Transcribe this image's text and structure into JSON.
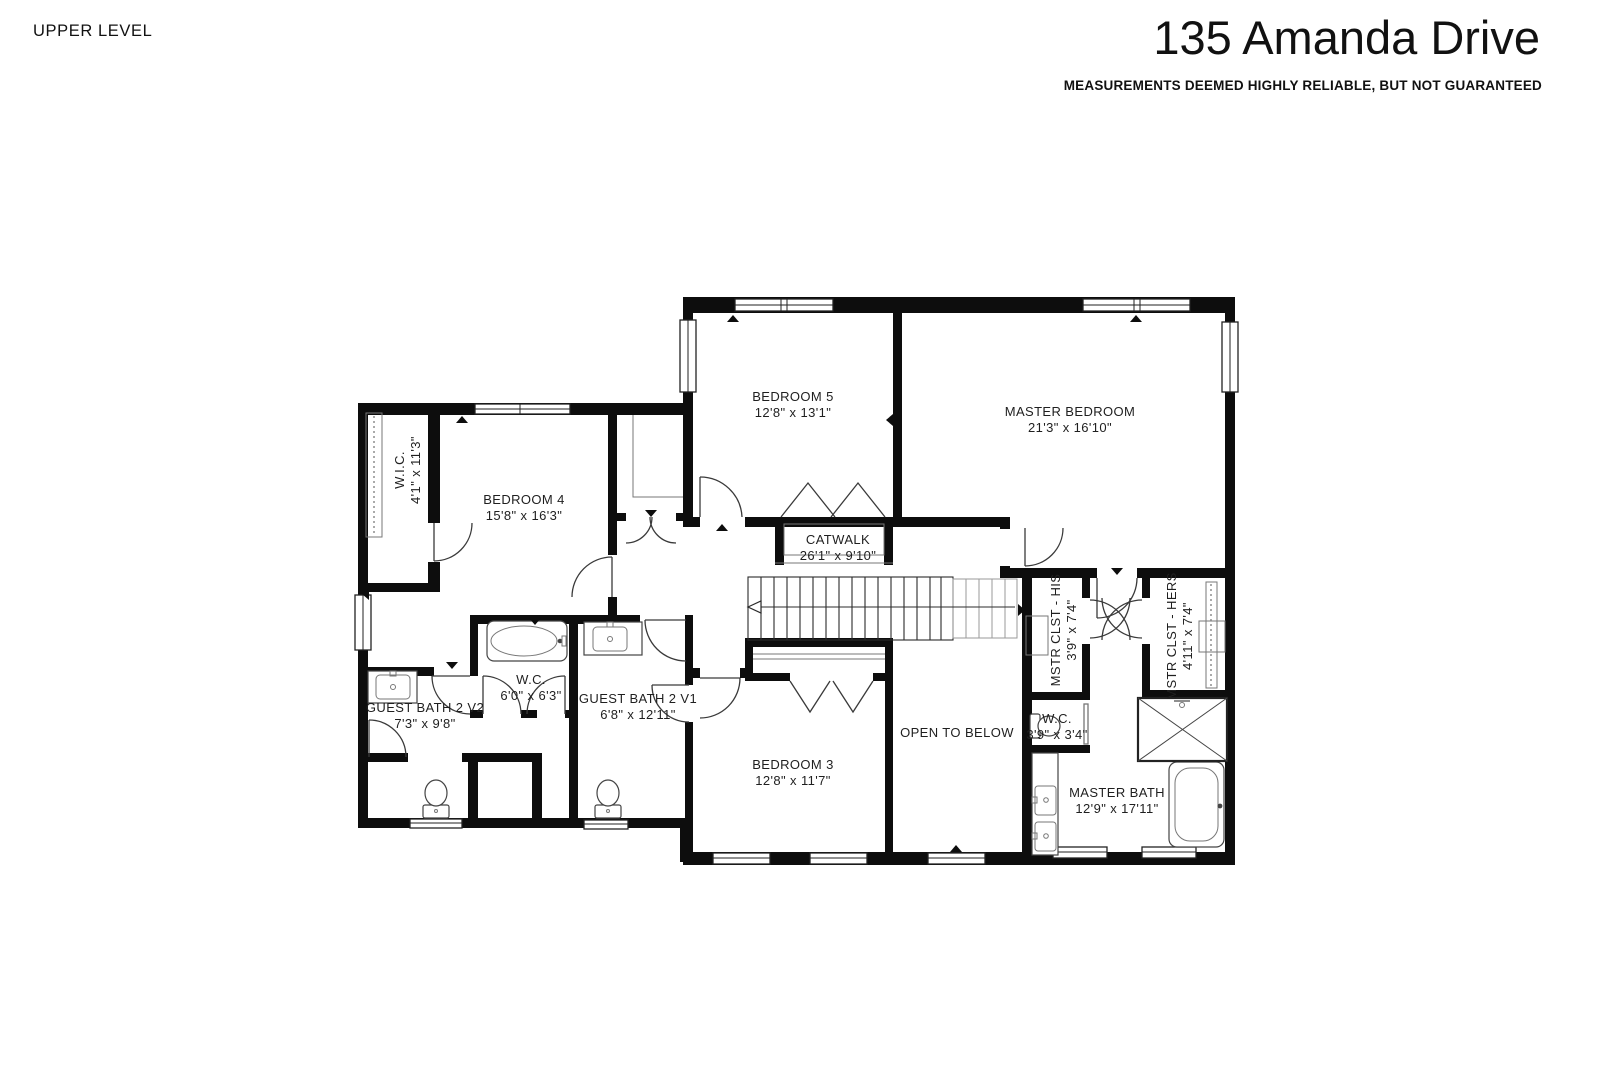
{
  "header": {
    "level_label": "UPPER LEVEL",
    "title": "135 Amanda Drive",
    "disclaimer": "MEASUREMENTS DEEMED HIGHLY RELIABLE, BUT NOT GUARANTEED"
  },
  "plan": {
    "wall_color": "#0d0d0d",
    "label_color": "#1f1f1f",
    "rooms": [
      {
        "id": "bedroom-5",
        "name": "BEDROOM 5",
        "dims": "12'8\" x 13'1\"",
        "x": 793,
        "y": 397,
        "rot": 0
      },
      {
        "id": "master-bedroom",
        "name": "MASTER BEDROOM",
        "dims": "21'3\" x 16'10\"",
        "x": 1070,
        "y": 412,
        "rot": 0
      },
      {
        "id": "wic",
        "name": "W.I.C.",
        "dims": "4'1\" x 11'3\"",
        "x": 408,
        "y": 470,
        "rot": -90
      },
      {
        "id": "bedroom-4",
        "name": "BEDROOM 4",
        "dims": "15'8\" x 16'3\"",
        "x": 524,
        "y": 500,
        "rot": 0
      },
      {
        "id": "catwalk",
        "name": "CATWALK",
        "dims": "26'1\" x 9'10\"",
        "x": 838,
        "y": 540,
        "rot": 0
      },
      {
        "id": "guest-bath-2-v2",
        "name": "GUEST BATH 2 V2",
        "dims": "7'3\" x 9'8\"",
        "x": 425,
        "y": 708,
        "rot": 0
      },
      {
        "id": "wc-guest",
        "name": "W.C.",
        "dims": "6'0\" x 6'3\"",
        "x": 531,
        "y": 680,
        "rot": 0
      },
      {
        "id": "guest-bath-2-v1",
        "name": "GUEST BATH 2 V1",
        "dims": "6'8\" x 12'11\"",
        "x": 638,
        "y": 699,
        "rot": 0
      },
      {
        "id": "bedroom-3",
        "name": "BEDROOM 3",
        "dims": "12'8\" x 11'7\"",
        "x": 793,
        "y": 765,
        "rot": 0
      },
      {
        "id": "open-to-below",
        "name": "OPEN TO BELOW",
        "dims": "",
        "x": 957,
        "y": 733,
        "rot": 0
      },
      {
        "id": "mstr-clst-his",
        "name": "MSTR CLST - HIS",
        "dims": "3'9\" x 7'4\"",
        "x": 1064,
        "y": 630,
        "rot": -90
      },
      {
        "id": "mstr-clst-hers",
        "name": "MSTR CLST - HERS",
        "dims": "4'11\" x 7'4\"",
        "x": 1180,
        "y": 636,
        "rot": -90
      },
      {
        "id": "wc-master",
        "name": "W.C.",
        "dims": "3'9\" x 3'4\"",
        "x": 1057,
        "y": 719,
        "rot": 0
      },
      {
        "id": "master-bath",
        "name": "MASTER BATH",
        "dims": "12'9\" x 17'11\"",
        "x": 1117,
        "y": 793,
        "rot": 0
      }
    ]
  }
}
